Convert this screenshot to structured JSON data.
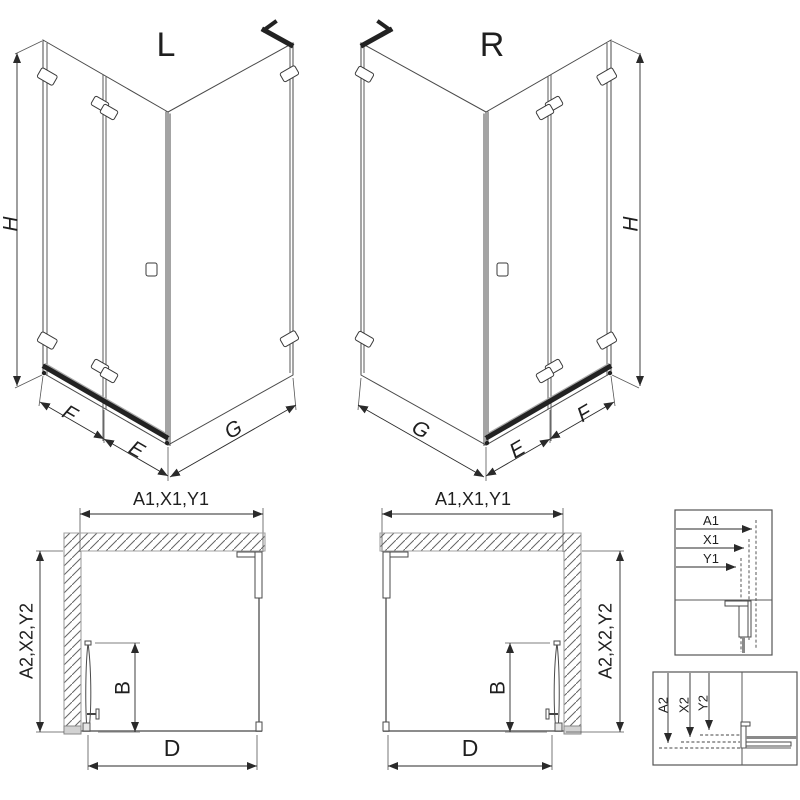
{
  "figure": {
    "iso_left": {
      "label": "L",
      "h": "H",
      "f": "F",
      "e": "E",
      "g": "G"
    },
    "iso_right": {
      "label": "R",
      "h": "H",
      "f": "F",
      "e": "E",
      "g": "G"
    },
    "plan_left": {
      "top": "A1,X1,Y1",
      "side": "A2,X2,Y2",
      "b": "B",
      "d": "D"
    },
    "plan_right": {
      "top": "A1,X1,Y1",
      "side": "A2,X2,Y2",
      "b": "B",
      "d": "D"
    },
    "detail_top": {
      "a1": "A1",
      "x1": "X1",
      "y1": "Y1"
    },
    "detail_bottom": {
      "a2": "A2",
      "x2": "X2",
      "y2": "Y2"
    },
    "colors": {
      "background": "#ffffff",
      "line": "#3a3a3a",
      "glass": "#8c8c8c",
      "dimension": "#2a2a2a",
      "hatch": "#606060",
      "fixture": "#222222"
    }
  }
}
